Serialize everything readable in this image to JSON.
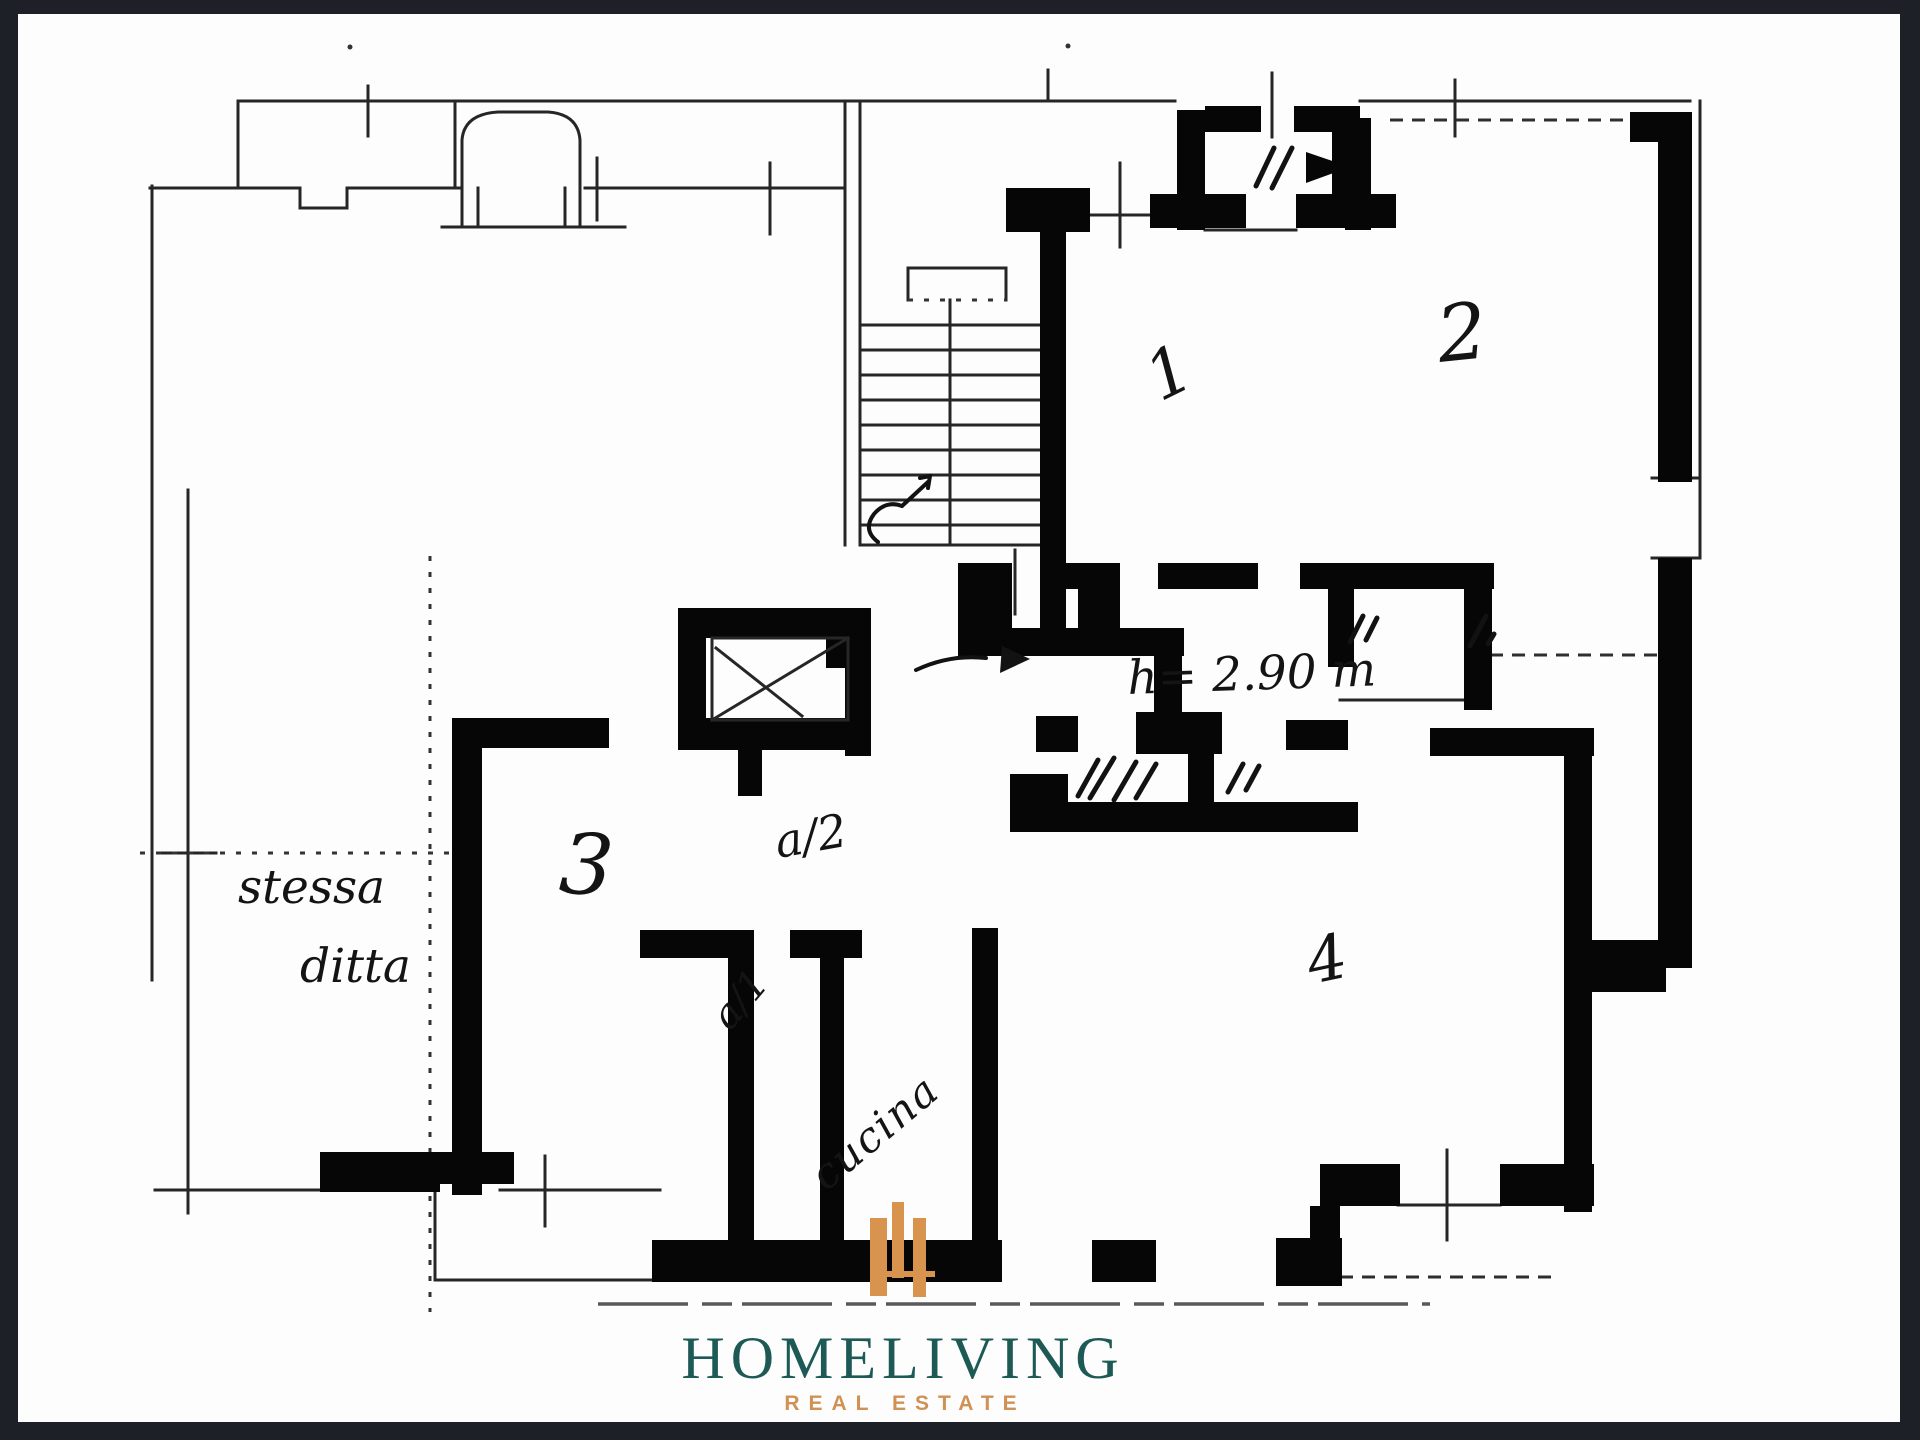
{
  "frame": {
    "background_color": "#1d2026",
    "paper_color": "#fdfdfd"
  },
  "plan": {
    "type": "scanned floor plan",
    "room_labels": {
      "room1": "1",
      "room2": "2",
      "room3": "3",
      "room4": "4"
    },
    "annotations": {
      "height_note": "h= 2.90 m",
      "same_company_line1": "stessa",
      "same_company_line2": "ditta",
      "unit_a2": "a/2",
      "unit_a1": "a/1",
      "kitchen": "cucina"
    }
  },
  "logo": {
    "monogram": "H",
    "monogram_color": "#d8944f",
    "brand": "HOMELIVING",
    "brand_color": "#1d5a56",
    "tagline": "REAL ESTATE",
    "tagline_color": "#cf9254"
  }
}
